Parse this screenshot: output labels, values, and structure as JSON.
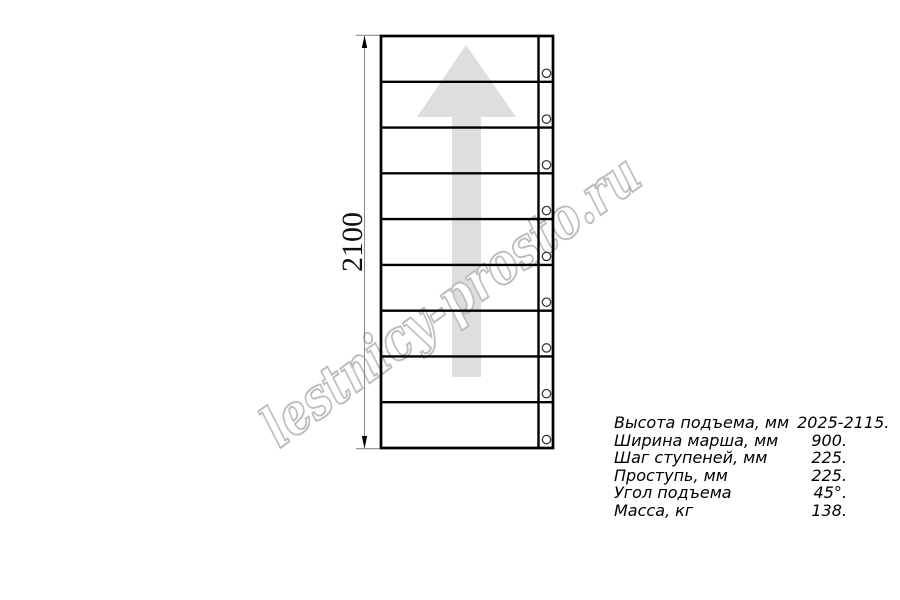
{
  "watermark": {
    "text": "lestnicy-prosto.ru",
    "outline_color": "#bdbdbd"
  },
  "drawing": {
    "dimension_label": "2100",
    "tread_count": 9,
    "hole_count": 9,
    "line_color": "#000000",
    "thin_line_color": "#8c8c8c",
    "arrow_color": "#dedede"
  },
  "specs": {
    "rows": [
      {
        "label": "Высота подъема, мм",
        "value": "2025-2115."
      },
      {
        "label": "Ширина марша, мм",
        "value": "900."
      },
      {
        "label": "Шаг ступеней, мм",
        "value": "225."
      },
      {
        "label": "Проступь, мм",
        "value": "225."
      },
      {
        "label": "Угол подъема",
        "value": "45°."
      },
      {
        "label": "Масса, кг",
        "value": "138."
      }
    ]
  }
}
